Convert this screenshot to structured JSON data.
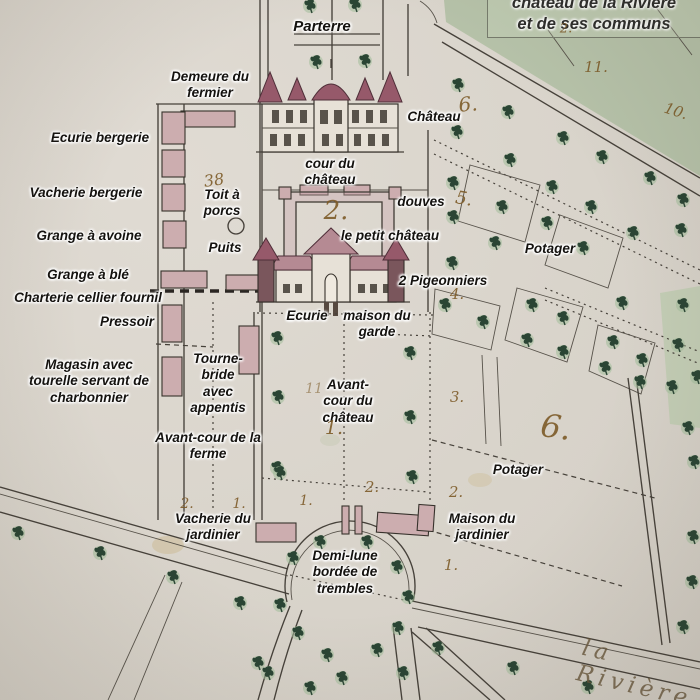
{
  "map_title_box": {
    "line1": "château de la Rivière",
    "line2": "et de ses communs"
  },
  "labels": [
    {
      "id": "parterre",
      "text": "Parterre"
    },
    {
      "id": "demeure-du-fermier",
      "text": "Demeure du\nfermier"
    },
    {
      "id": "ecurie-bergerie",
      "text": "Ecurie bergerie"
    },
    {
      "id": "vacherie-bergerie",
      "text": "Vacherie bergerie"
    },
    {
      "id": "grange-a-avoine",
      "text": "Grange à avoine"
    },
    {
      "id": "grange-a-ble",
      "text": "Grange à blé"
    },
    {
      "id": "charterie",
      "text": "Charterie cellier fournil"
    },
    {
      "id": "pressoir",
      "text": "Pressoir"
    },
    {
      "id": "magasin",
      "text": "Magasin avec\ntourelle servant de\ncharbonnier"
    },
    {
      "id": "toit-a-porcs",
      "text": "Toit à\nporcs"
    },
    {
      "id": "puits",
      "text": "Puits"
    },
    {
      "id": "chateau",
      "text": "Château"
    },
    {
      "id": "cour-du-chateau",
      "text": "cour du\nchâteau"
    },
    {
      "id": "douves",
      "text": "douves"
    },
    {
      "id": "le-petit-chateau",
      "text": "le petit château"
    },
    {
      "id": "pigeonniers",
      "text": "2 Pigeonniers"
    },
    {
      "id": "ecurie",
      "text": "Ecurie"
    },
    {
      "id": "maison-du-garde",
      "text": "maison du\ngarde"
    },
    {
      "id": "tourne-bride",
      "text": "Tourne-\nbride\navec\nappentis"
    },
    {
      "id": "avant-cour-du-chateau",
      "text": "Avant-\ncour du\nchâteau"
    },
    {
      "id": "avant-cour-de-la-ferme",
      "text": "Avant-cour de la\nferme"
    },
    {
      "id": "potager-haut",
      "text": "Potager"
    },
    {
      "id": "potager-bas",
      "text": "Potager"
    },
    {
      "id": "vacherie-du-jardinier",
      "text": "Vacherie du\njardinier"
    },
    {
      "id": "maison-du-jardinier",
      "text": "Maison du\njardinier"
    },
    {
      "id": "demi-lune",
      "text": "Demi-lune\nbordée de\ntrembles"
    }
  ],
  "handwritten_numbers": [
    {
      "id": "n38",
      "text": "38"
    },
    {
      "id": "n2-cour",
      "text": "2."
    },
    {
      "id": "n1-avant",
      "text": "1."
    },
    {
      "id": "n11-avant",
      "text": "11"
    },
    {
      "id": "n6-haut",
      "text": "6."
    },
    {
      "id": "n5",
      "text": "5."
    },
    {
      "id": "n11-champ",
      "text": "11."
    },
    {
      "id": "n10-champ",
      "text": "10."
    },
    {
      "id": "n2-champ",
      "text": "2."
    },
    {
      "id": "n4",
      "text": "4."
    },
    {
      "id": "n3",
      "text": "3."
    },
    {
      "id": "n6-potager",
      "text": "6."
    },
    {
      "id": "n2-potager",
      "text": "2."
    },
    {
      "id": "n1-jardinier",
      "text": "1."
    },
    {
      "id": "n2-vacherie",
      "text": "2."
    },
    {
      "id": "n1-vacherie",
      "text": "1."
    },
    {
      "id": "n1-demilune",
      "text": "1."
    },
    {
      "id": "n2-demilune",
      "text": "2."
    }
  ],
  "road_name": "la Rivière",
  "colors": {
    "paper": "#d9d4cb",
    "field_green": "#b6c2a9",
    "strip_green": "#c0cdb2",
    "tree_ink": "#2a4534",
    "tree_halo": "#a3bd9a",
    "building_pink": "#ccadaf",
    "roof_maroon": "#96596a",
    "line_ink": "#46413a",
    "hand_ink": "#7d5b28"
  }
}
